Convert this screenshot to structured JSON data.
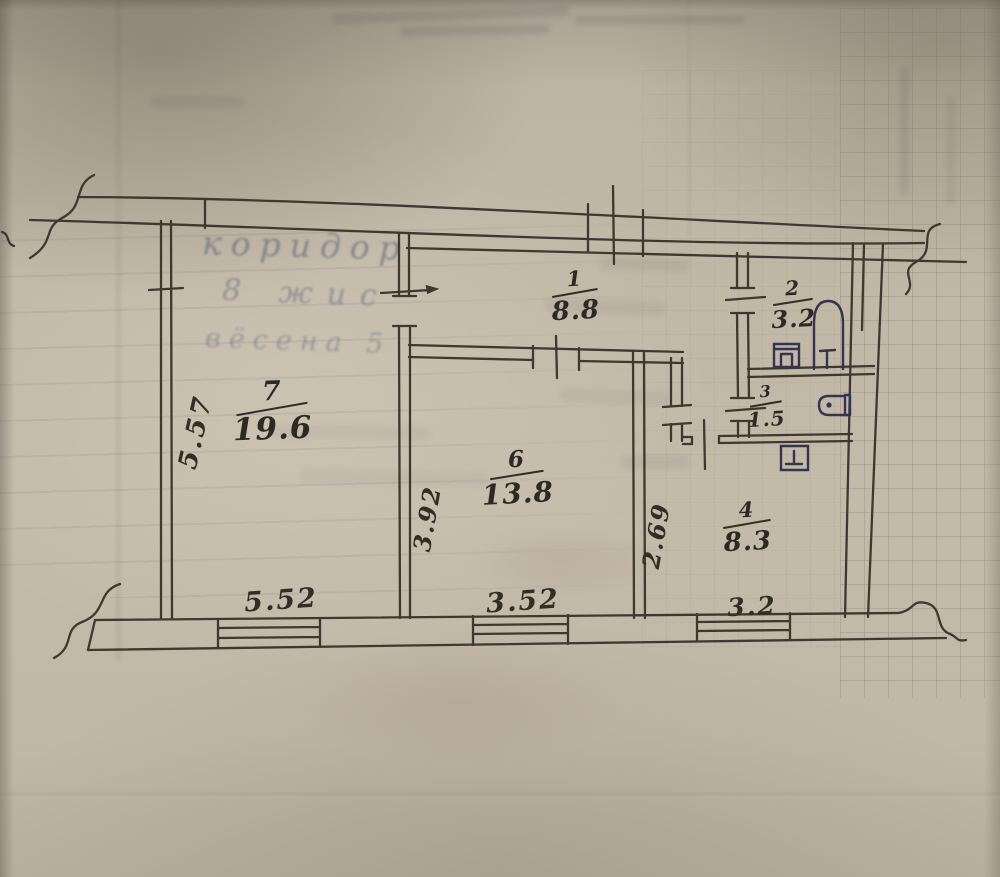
{
  "plan": {
    "rooms": [
      {
        "key": "room1",
        "number": "1",
        "area": "8.8"
      },
      {
        "key": "room2",
        "number": "2",
        "area": "3.2"
      },
      {
        "key": "room3",
        "number": "3",
        "area": "1.5"
      },
      {
        "key": "room4",
        "number": "4",
        "area": "8.3"
      },
      {
        "key": "room6",
        "number": "6",
        "area": "13.8"
      },
      {
        "key": "room7",
        "number": "7",
        "area": "19.6"
      }
    ],
    "dimensions": {
      "left_height": "5.57",
      "room6_height": "3.92",
      "room4_height": "2.69",
      "bottom_room7": "5.52",
      "bottom_room6": "3.52",
      "bottom_room4": "3.2"
    },
    "ghost_notes": {
      "line1": "коридор",
      "line2": "8 жис",
      "line3": "вёсена 5"
    },
    "colors": {
      "ink": "#3f382e",
      "fixture_ink": "#34344e",
      "paper": "#c2b8a7"
    }
  }
}
